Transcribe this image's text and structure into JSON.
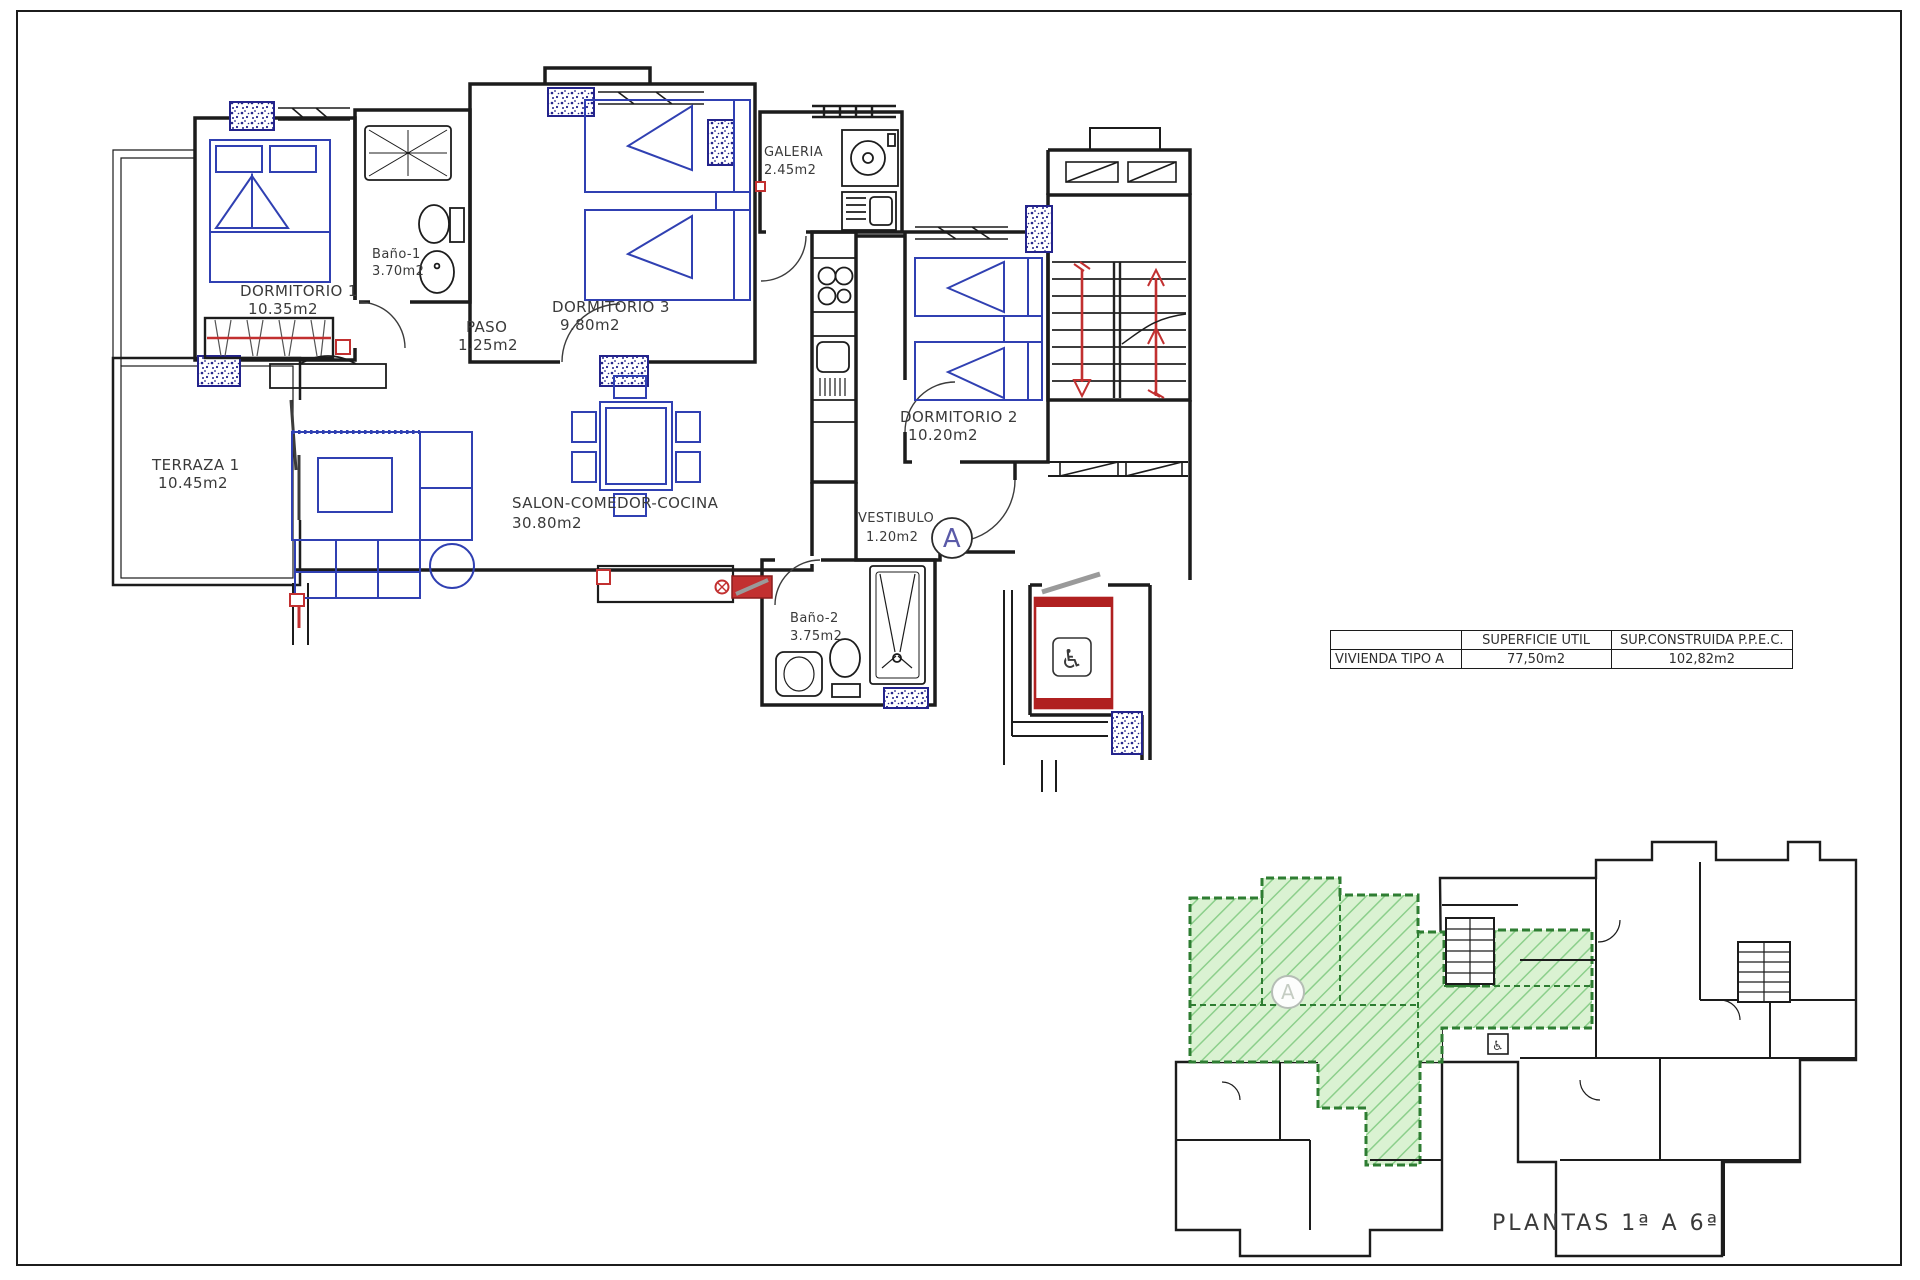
{
  "sheet": {
    "key_plan_title": "PLANTAS 1ª A 6ª",
    "unit_letter": "A"
  },
  "rooms": {
    "dormitorio1": {
      "name": "DORMITORIO 1",
      "area": "10.35m2"
    },
    "bano1": {
      "name": "Baño-1",
      "area": "3.70m2"
    },
    "dormitorio3": {
      "name": "DORMITORIO 3",
      "area": "9.80m2"
    },
    "galeria": {
      "name": "GALERIA",
      "area": "2.45m2"
    },
    "paso": {
      "name": "PASO",
      "area": "1.25m2"
    },
    "terraza1": {
      "name": "TERRAZA 1",
      "area": "10.45m2"
    },
    "salon": {
      "name": "SALON-COMEDOR-COCINA",
      "area": "30.80m2"
    },
    "dormitorio2": {
      "name": "DORMITORIO 2",
      "area": "10.20m2"
    },
    "vestibulo": {
      "name": "VESTIBULO",
      "area": "1.20m2"
    },
    "bano2": {
      "name": "Baño-2",
      "area": "3.75m2"
    }
  },
  "summary_table": {
    "header_superficie": "SUPERFICIE UTIL",
    "header_construida": "SUP.CONSTRUIDA P.P.E.C.",
    "row_label": "VIVIENDA TIPO A",
    "superficie_util": "77,50m2",
    "sup_construida": "102,82m2"
  },
  "icons": {
    "wheelchair": "♿"
  },
  "colors": {
    "wall_black": "#1c1c1c",
    "furniture_blue": "#3040b2",
    "accent_red": "#c23030",
    "highlight_green": "#daf2d2",
    "hatch_green": "#8ccf8b",
    "green_wall": "#2e7d32"
  }
}
